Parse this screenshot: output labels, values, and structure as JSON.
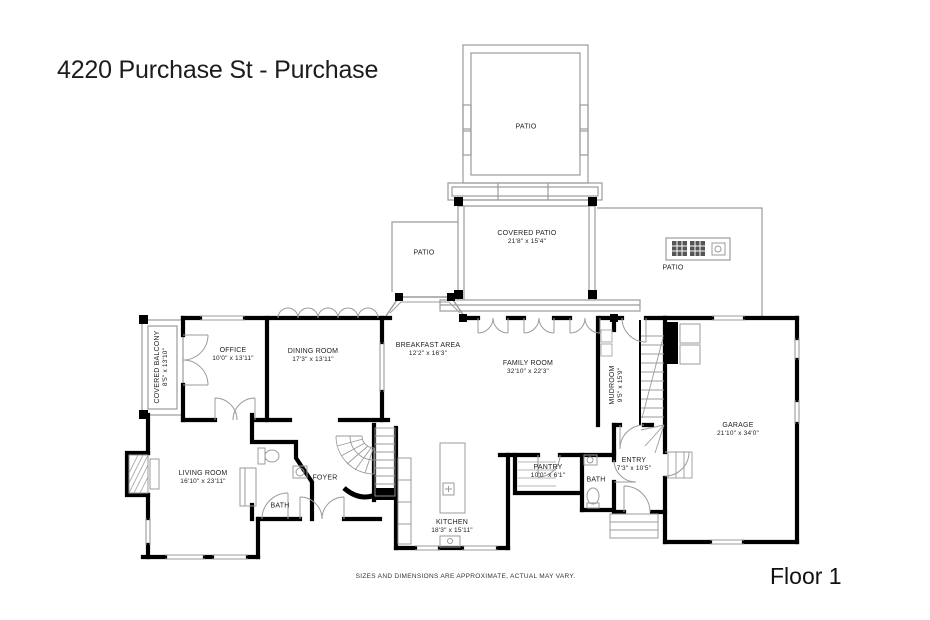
{
  "header": {
    "title": "4220 Purchase St - Purchase"
  },
  "footer": {
    "disclaimer": "SIZES AND DIMENSIONS ARE APPROXIMATE, ACTUAL MAY VARY.",
    "floor_label": "Floor 1"
  },
  "colors": {
    "wall": "#000000",
    "outline": "#9b9b9b",
    "text": "#222222"
  },
  "rooms": [
    {
      "id": "patio-top",
      "name": "PATIO",
      "dims": ""
    },
    {
      "id": "covered-patio",
      "name": "COVERED PATIO",
      "dims": "21'8\" x 15'4\""
    },
    {
      "id": "patio-left",
      "name": "PATIO",
      "dims": ""
    },
    {
      "id": "patio-right",
      "name": "PATIO",
      "dims": ""
    },
    {
      "id": "covered-balcony",
      "name": "COVERED BALCONY",
      "dims": "8'5\" x 13'10\""
    },
    {
      "id": "office",
      "name": "OFFICE",
      "dims": "10'0\" x 13'11\""
    },
    {
      "id": "dining-room",
      "name": "DINING ROOM",
      "dims": "17'3\" x 13'11\""
    },
    {
      "id": "breakfast-area",
      "name": "BREAKFAST AREA",
      "dims": "12'2\" x 16'3\""
    },
    {
      "id": "family-room",
      "name": "FAMILY ROOM",
      "dims": "32'10\" x 22'3\""
    },
    {
      "id": "mudroom",
      "name": "MUDROOM",
      "dims": "9'5\" x 15'9\""
    },
    {
      "id": "garage",
      "name": "GARAGE",
      "dims": "21'10\" x 34'0\""
    },
    {
      "id": "living-room",
      "name": "LIVING ROOM",
      "dims": "16'10\" x 23'11\""
    },
    {
      "id": "foyer",
      "name": "FOYER",
      "dims": ""
    },
    {
      "id": "bath-powder",
      "name": "BATH",
      "dims": ""
    },
    {
      "id": "kitchen",
      "name": "KITCHEN",
      "dims": "18'3\" x 15'11\""
    },
    {
      "id": "pantry",
      "name": "PANTRY",
      "dims": "10'0\" x 6'1\""
    },
    {
      "id": "bath-hall",
      "name": "BATH",
      "dims": ""
    },
    {
      "id": "entry",
      "name": "ENTRY",
      "dims": "7'3\" x 10'5\""
    }
  ]
}
